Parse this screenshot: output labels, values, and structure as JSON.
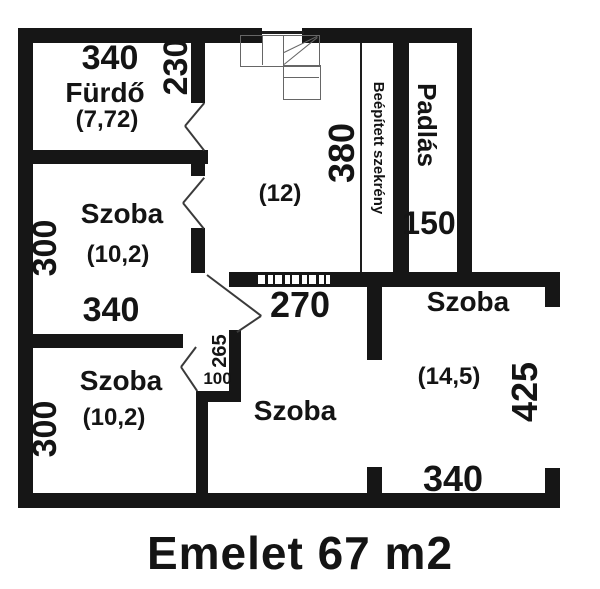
{
  "title": "Emelet 67 m2",
  "labels": {
    "furdo": {
      "name": "Fürdő",
      "area": "(7,72)",
      "dim_width": "340"
    },
    "hall": {
      "area": "(12)",
      "dim_height": "380",
      "dim_door": "230"
    },
    "szekreny": {
      "name": "Beépített szekrény"
    },
    "padlas": {
      "name": "Padlás",
      "dim_width": "150"
    },
    "szoba_mid": {
      "name": "Szoba",
      "area": "(10,2)",
      "dim_height": "300",
      "dim_width": "340"
    },
    "szoba_bottom_left": {
      "name": "Szoba",
      "area": "(10,2)",
      "dim_height": "300"
    },
    "szoba_bottom_mid": {
      "name": "Szoba",
      "dim_pass_a": "265",
      "dim_pass_b": "100"
    },
    "szoba_right": {
      "name": "Szoba",
      "area": "(14,5)",
      "dim_top": "270",
      "dim_height": "425",
      "dim_width": "340"
    }
  }
}
